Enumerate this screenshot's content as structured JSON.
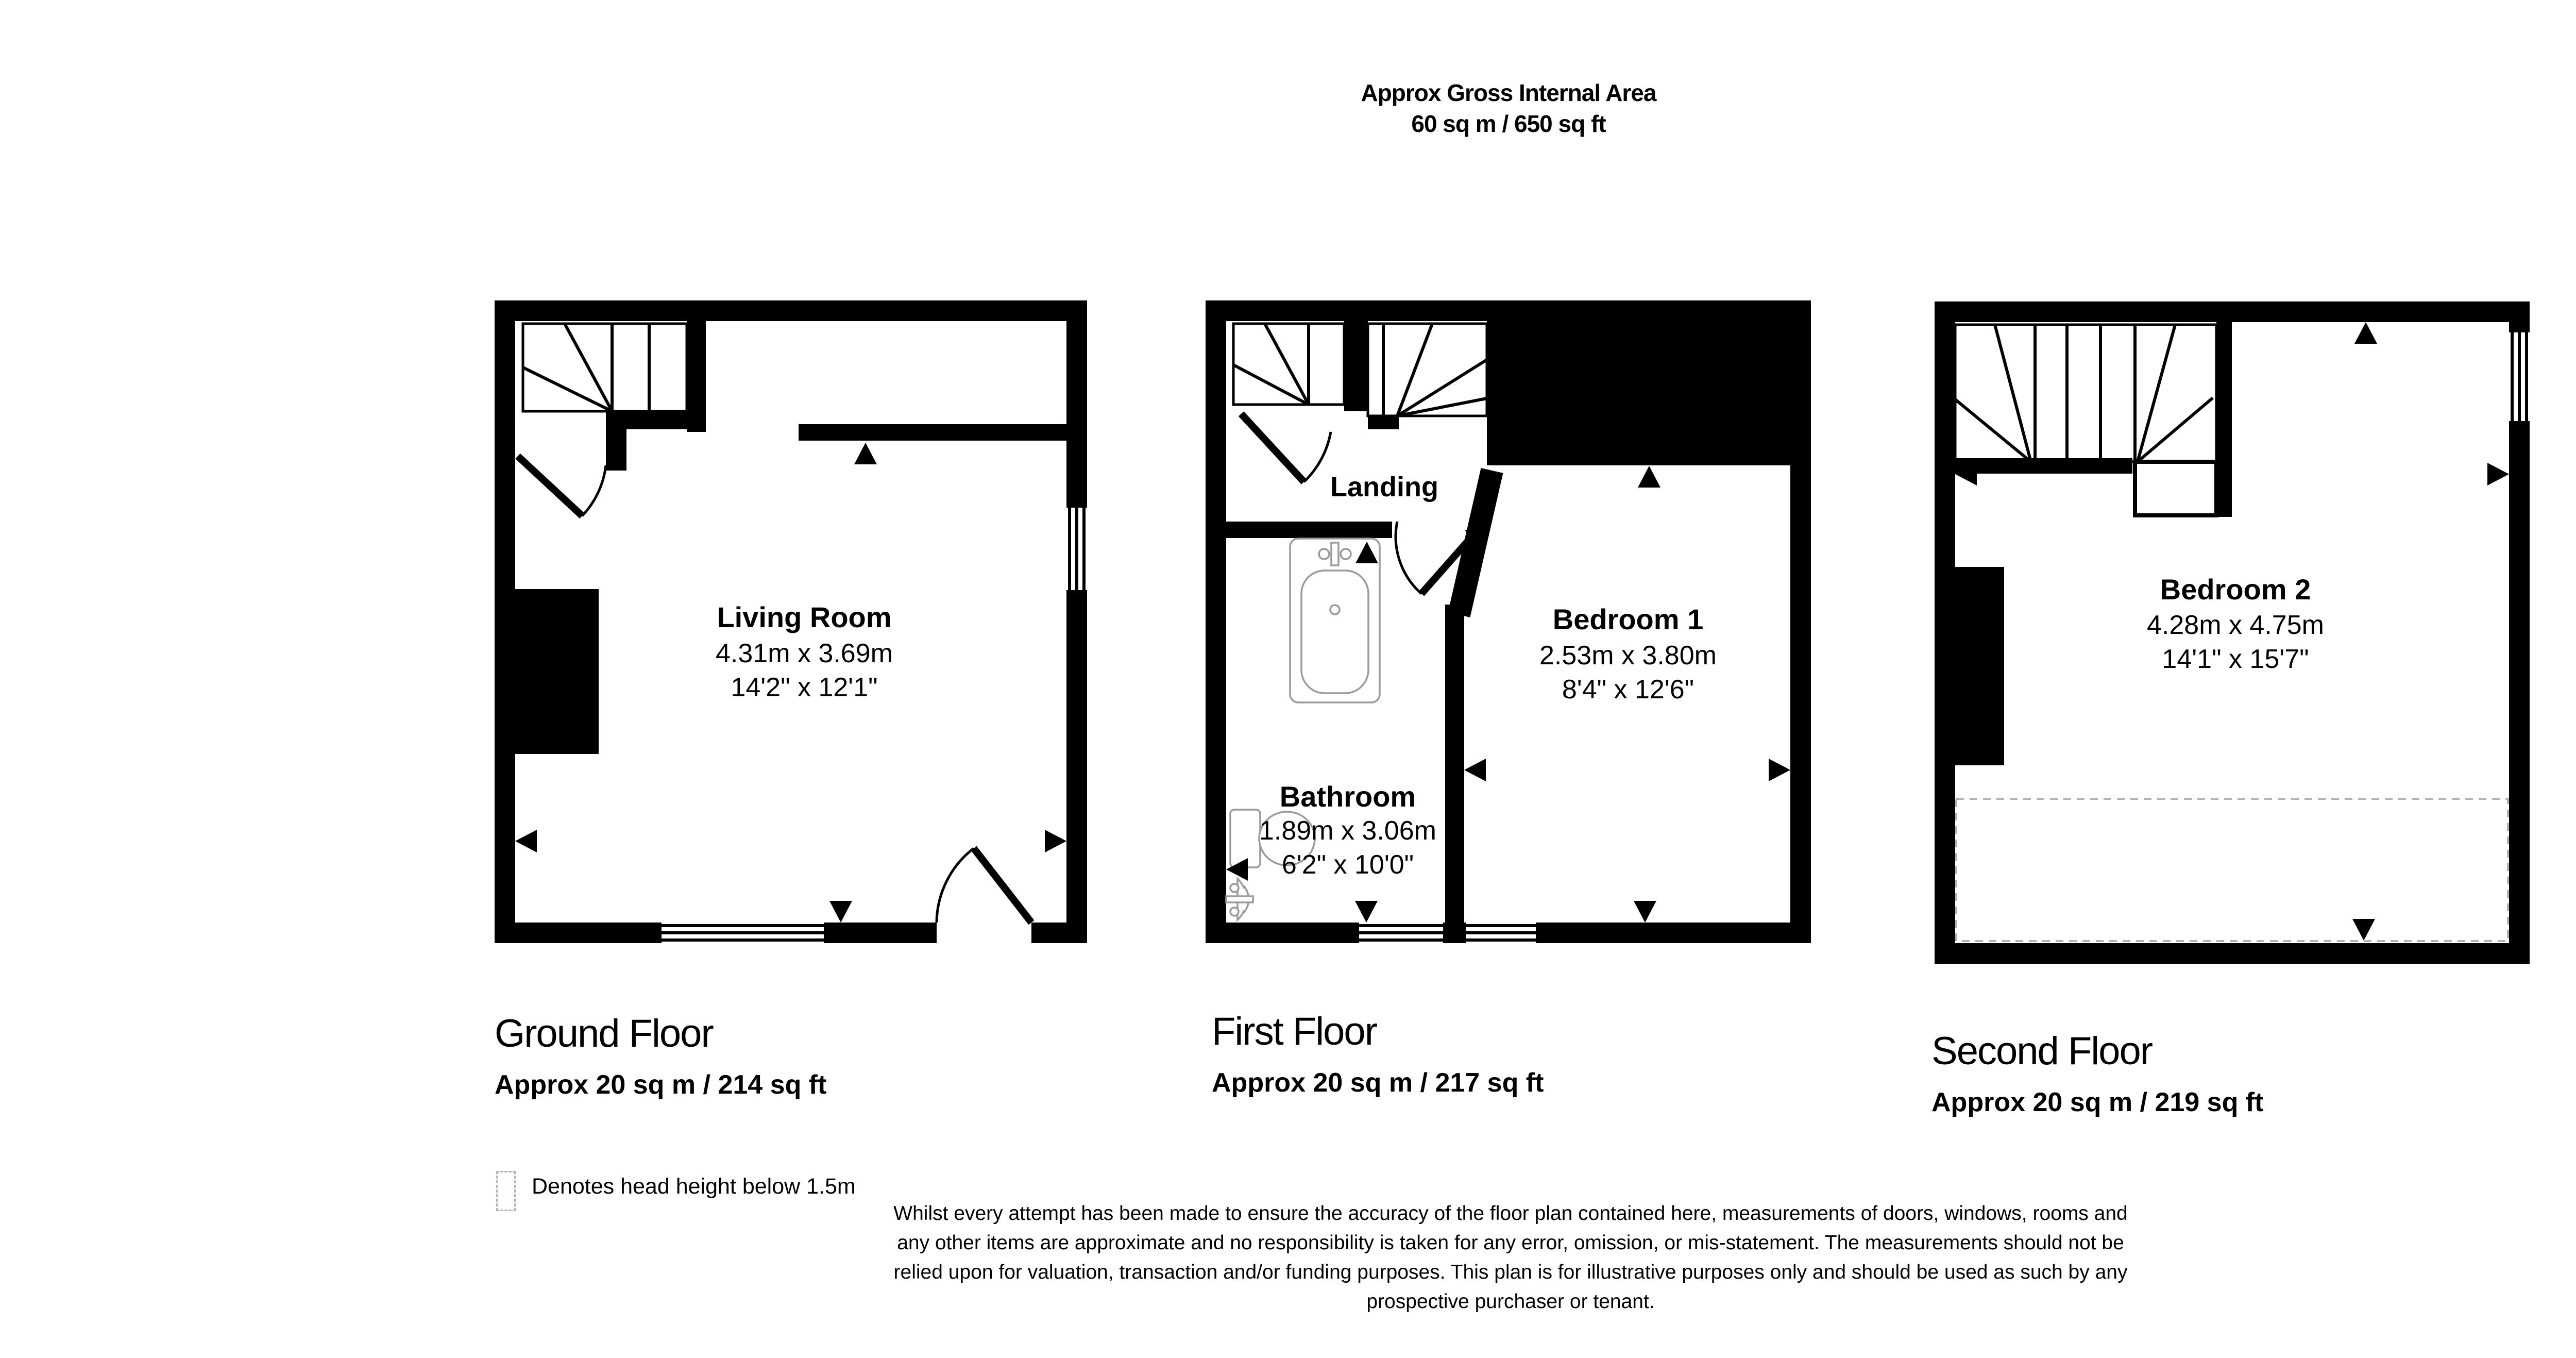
{
  "title": {
    "line1": "Approx Gross Internal Area",
    "line2": "60 sq m / 650 sq ft"
  },
  "compass": {
    "n": "N",
    "e": "E",
    "s": "S",
    "w": "W"
  },
  "floors": [
    {
      "name": "Ground Floor",
      "area": "Approx 20 sq m / 214 sq ft",
      "rooms": [
        {
          "name": "Living Room",
          "metric": "4.31m x 3.69m",
          "imperial": "14'2\" x 12'1\""
        }
      ]
    },
    {
      "name": "First Floor",
      "area": "Approx 20 sq m / 217 sq ft",
      "rooms": [
        {
          "name": "Landing"
        },
        {
          "name": "Bedroom 1",
          "metric": "2.53m x 3.80m",
          "imperial": "8'4\" x 12'6\""
        },
        {
          "name": "Bathroom",
          "metric": "1.89m x 3.06m",
          "imperial": "6'2\" x 10'0\""
        }
      ]
    },
    {
      "name": "Second Floor",
      "area": "Approx 20 sq m / 219 sq ft",
      "rooms": [
        {
          "name": "Bedroom 2",
          "metric": "4.28m x 4.75m",
          "imperial": "14'1\" x 15'7\""
        }
      ]
    }
  ],
  "legend": {
    "text": "Denotes head height below 1.5m"
  },
  "disclaimer": {
    "line1": "Whilst every attempt has been made to ensure the accuracy of the floor plan contained here, measurements of doors, windows, rooms and",
    "line2": "any other items are approximate and no responsibility is taken for any error, omission, or mis-statement. The measurements should not be",
    "line3": "relied upon for valuation, transaction and/or funding purposes. This plan is for illustrative purposes only and should be used as such by any",
    "line4": "prospective purchaser or tenant."
  },
  "colors": {
    "wall": "#000000",
    "fixture_outline": "#9a9a9a",
    "dashed_gray": "#b3b3b3",
    "compass": "#333333"
  }
}
